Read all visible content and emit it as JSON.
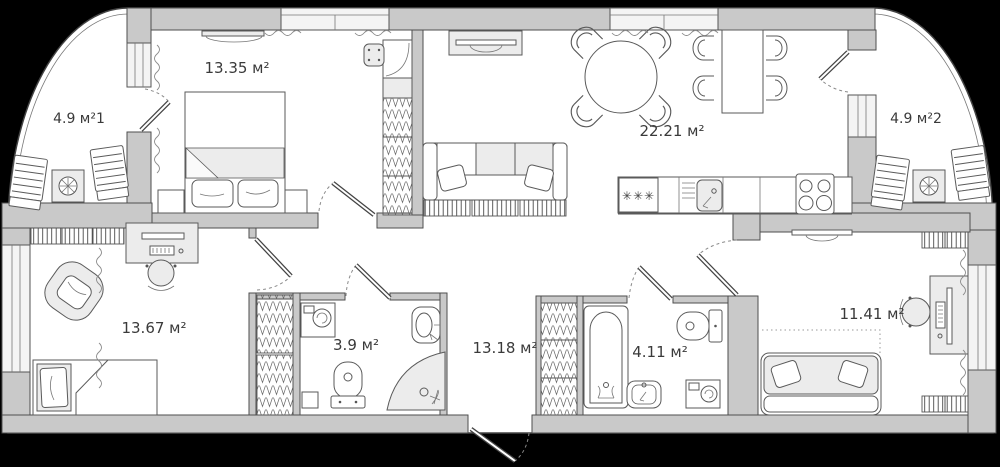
{
  "plan": {
    "title": "apartment-floor-plan",
    "units": "м²"
  },
  "palette": {
    "background": "#000000",
    "wall_fill": "#c9c9c9",
    "wall_stroke": "#4e4e4e",
    "floor": "#ffffff",
    "furniture_fill": "#f1f1f1",
    "furniture_gray": "#ececec",
    "label_color": "#3a3a3a"
  },
  "rooms": {
    "bedroom": {
      "area_label": "13.35 м²"
    },
    "balcony_left": {
      "area_label": "4.9 м²1"
    },
    "living_kitchen": {
      "area_label": "22.21 м²"
    },
    "balcony_right": {
      "area_label": "4.9 м²2"
    },
    "room_bottom_left": {
      "area_label": "13.67 м²"
    },
    "bathroom_small": {
      "area_label": "3.9 м²"
    },
    "hallway": {
      "area_label": "13.18 м²"
    },
    "bathroom_large": {
      "area_label": "4.11 м²"
    },
    "room_bottom_right": {
      "area_label": "11.41 м²"
    }
  },
  "fixtures": {
    "freezer_symbol": "✳✳✳"
  }
}
